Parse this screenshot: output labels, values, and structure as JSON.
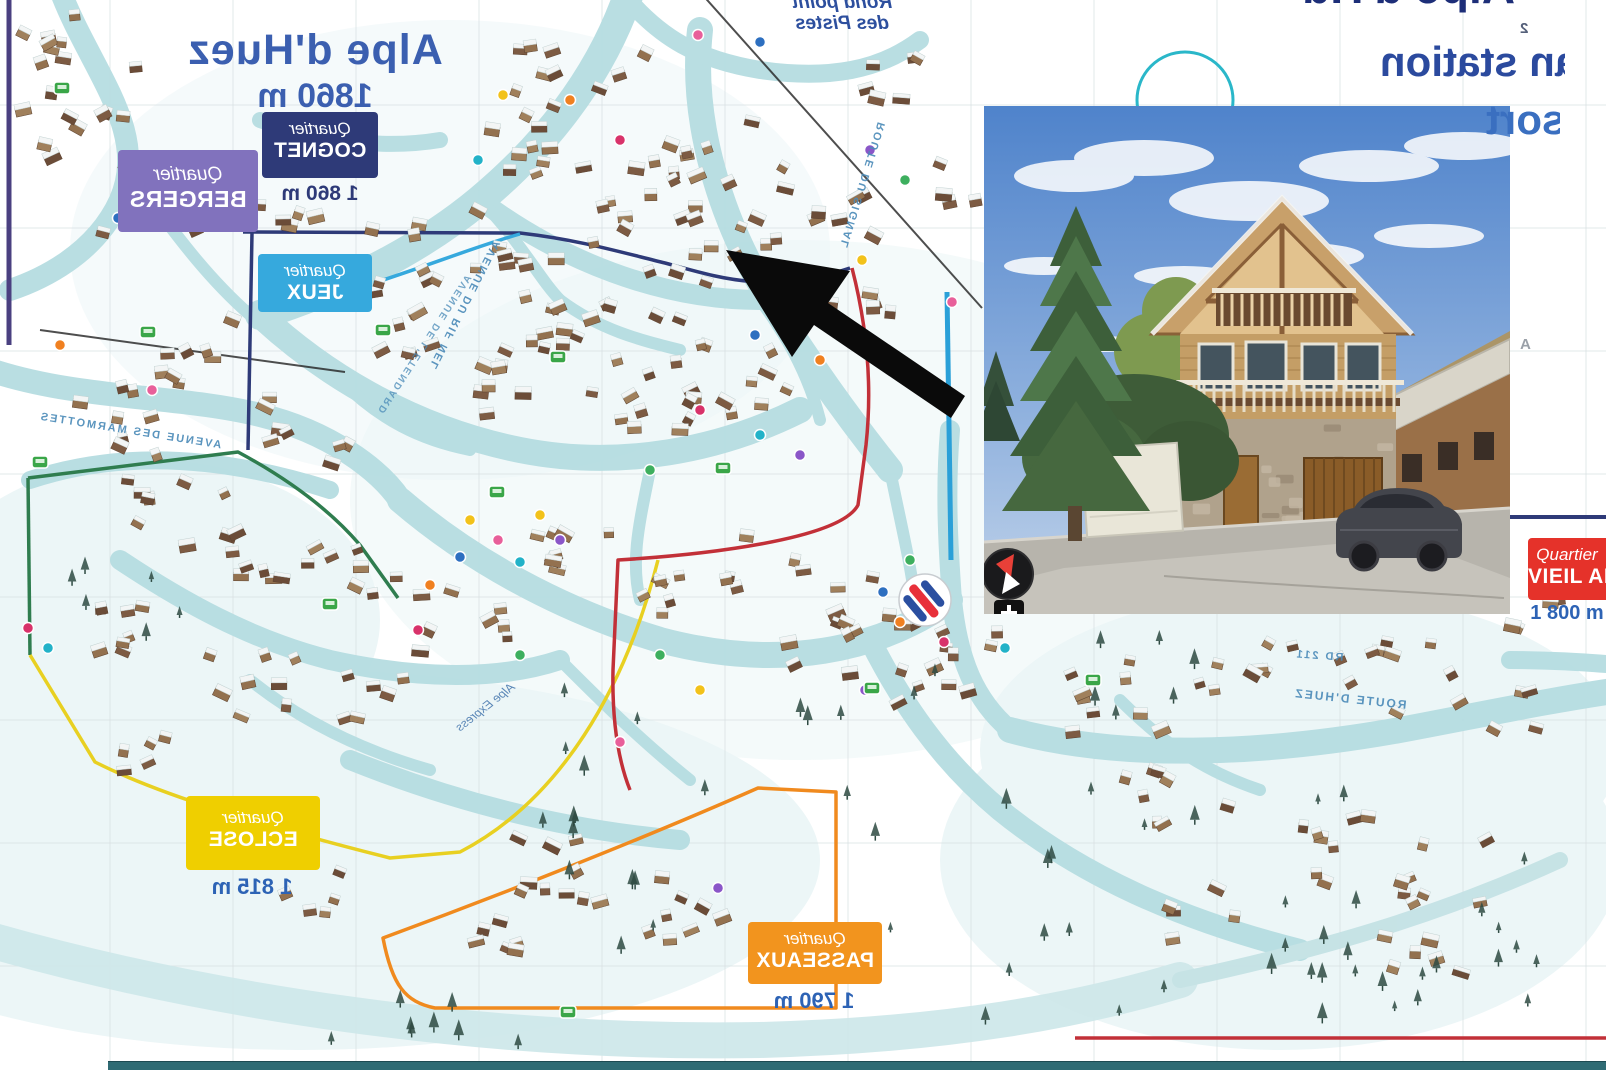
{
  "titles": {
    "main_line1": "Alpe d'Huez",
    "main_line2": "1860 m",
    "corner_line1": "Alpe d'Huez",
    "corner_line2": "Plan station",
    "corner_line3": "resort"
  },
  "landmarks": {
    "rond_point_line1": "Rond point",
    "rond_point_line2": "des Pistes",
    "sector_2": "2",
    "sector_a": "A"
  },
  "quartier_word": "Quartier",
  "quartiers": [
    {
      "name": "BERGERS",
      "altitude": "",
      "color": "#8172bd"
    },
    {
      "name": "COGNET",
      "altitude": "1 860 m",
      "color": "#2e3a78"
    },
    {
      "name": "JEUX",
      "altitude": "",
      "color": "#36a9dd"
    },
    {
      "name": "ECLOSE",
      "altitude": "1 815 m",
      "color": "#efcf00"
    },
    {
      "name": "PASSEAUX",
      "altitude": "1 790 m",
      "color": "#f2941e"
    },
    {
      "name": "VIEIL ALPE",
      "altitude": "1 800 m",
      "color": "#e5322a"
    }
  ],
  "streets": [
    {
      "text": "AVENUE DES MARMOTTES"
    },
    {
      "text": "AVENUE DU RIF NEL"
    },
    {
      "text": "AVENUE DE L'ETENDARD"
    },
    {
      "text": "ROUTE DU SIGNAL"
    },
    {
      "text": "ROUTE D'HUEZ"
    },
    {
      "text": "RD 211"
    },
    {
      "text": "Alpe Express"
    }
  ],
  "colors": {
    "map_title": "#3b5fb0",
    "altitude_text": "#2d63b5",
    "road": "#b6dde1",
    "boundary_red": "#c23038",
    "boundary_orange": "#f08a1e",
    "boundary_yellow": "#e8d021",
    "boundary_green": "#2f7d4f",
    "boundary_navy": "#2e3a78",
    "boundary_purple": "#4a4080",
    "gondola_blue": "#2aa0d8",
    "arrow": "#0a0a0a",
    "bottom_bar": "#2f6b74"
  }
}
